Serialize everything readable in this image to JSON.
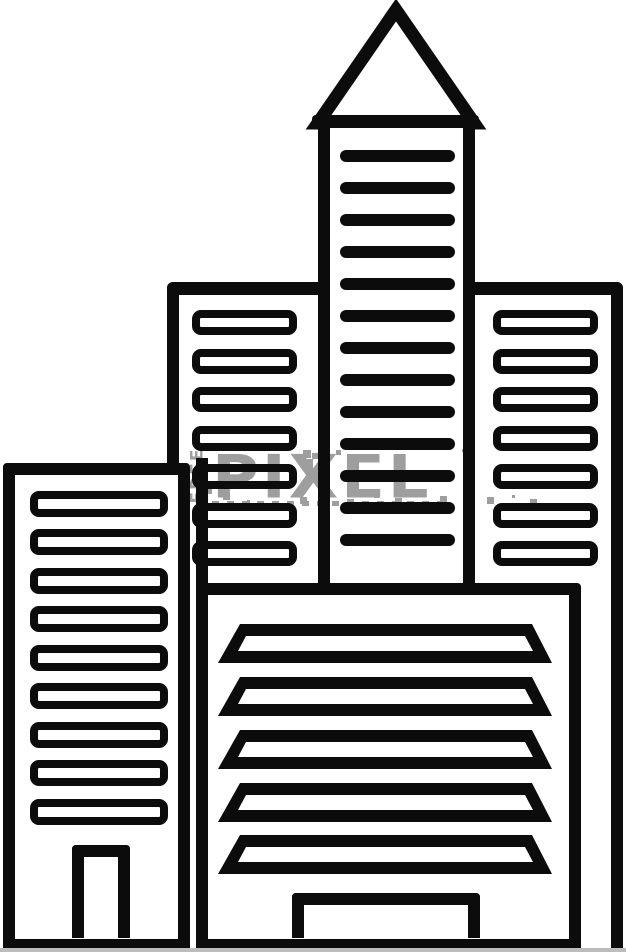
{
  "image": {
    "type": "clipart-line-drawing",
    "subject": "city skyline of four outlined office buildings",
    "background": "#ffffff",
    "line_color": "#0c0c0c",
    "bottom_edge_color": "#bdbdbd"
  },
  "watermark": {
    "vertical_text": "FREE",
    "main_text": "PIXEL",
    "color": "#9e9e9e"
  },
  "groups": {
    "back_left_windows": {
      "x": 192,
      "w": 105,
      "h": 25,
      "tops": [
        310,
        349,
        387,
        426,
        464,
        503,
        541
      ]
    },
    "back_right_windows": {
      "x": 493,
      "w": 105,
      "h": 25,
      "tops": [
        310,
        349,
        387,
        426,
        464,
        503,
        541
      ]
    },
    "tower_bars": {
      "x": 340,
      "w": 115,
      "h": 12,
      "tops": [
        150,
        182,
        214,
        246,
        278,
        310,
        342,
        374,
        406,
        438,
        470,
        502,
        534
      ]
    },
    "left_windows": {
      "x": 30,
      "w": 138,
      "h": 26,
      "tops": [
        491,
        529,
        568,
        606,
        645,
        683,
        722,
        760,
        799
      ]
    },
    "louvers": {
      "x": 218,
      "w": 334,
      "h": 39,
      "tops": [
        624,
        677,
        730,
        783,
        835
      ]
    }
  }
}
